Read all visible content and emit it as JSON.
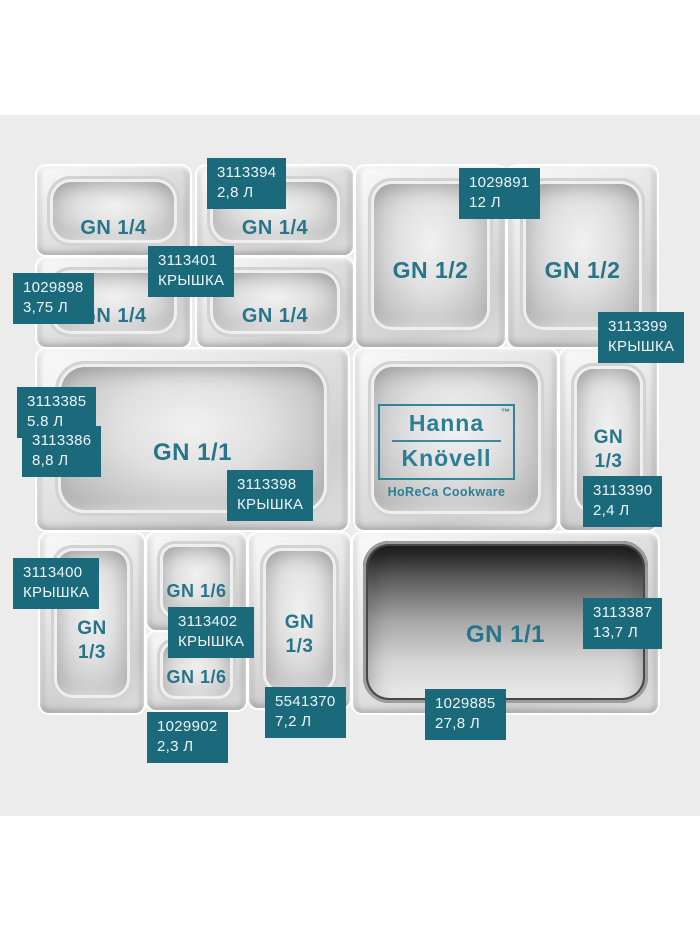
{
  "colors": {
    "accent_teal": "#2b7f94",
    "tag_background": "#1a6a7c",
    "pan_text_teal": "#27758a",
    "photo_background": "#ececec"
  },
  "brand": {
    "name_line1": "Hanna",
    "name_line2": "Knövell",
    "trademark": "™",
    "tagline": "HoReCa Cookware"
  },
  "pans": [
    {
      "label": "GN 1/4"
    },
    {
      "label": "GN 1/4"
    },
    {
      "label": "GN 1/4"
    },
    {
      "label": "GN 1/4"
    },
    {
      "label": "GN 1/2"
    },
    {
      "label": "GN 1/2"
    },
    {
      "label": "GN 1/1"
    },
    {
      "label": "GN\n1/3"
    },
    {
      "label": "GN\n1/3"
    },
    {
      "label": "GN 1/6"
    },
    {
      "label": "GN 1/6"
    },
    {
      "label": "GN\n1/3"
    },
    {
      "label": "GN 1/1"
    }
  ],
  "tags": [
    {
      "code": "3113394",
      "value": "2,8 Л"
    },
    {
      "code": "1029891",
      "value": "12 Л"
    },
    {
      "code": "3113401",
      "value": "КРЫШКА"
    },
    {
      "code": "1029898",
      "value": "3,75 Л"
    },
    {
      "code": "3113399",
      "value": "КРЫШКА"
    },
    {
      "code": "3113385",
      "value": "5.8 Л"
    },
    {
      "code": "3113386",
      "value": "8,8 Л"
    },
    {
      "code": "3113398",
      "value": "КРЫШКА"
    },
    {
      "code": "3113390",
      "value": "2,4 Л"
    },
    {
      "code": "3113400",
      "value": "КРЫШКА"
    },
    {
      "code": "3113402",
      "value": "КРЫШКА"
    },
    {
      "code": "3113387",
      "value": "13,7 Л"
    },
    {
      "code": "5541370",
      "value": "7,2 Л"
    },
    {
      "code": "1029885",
      "value": "27,8 Л"
    },
    {
      "code": "1029902",
      "value": "2,3 Л"
    }
  ]
}
